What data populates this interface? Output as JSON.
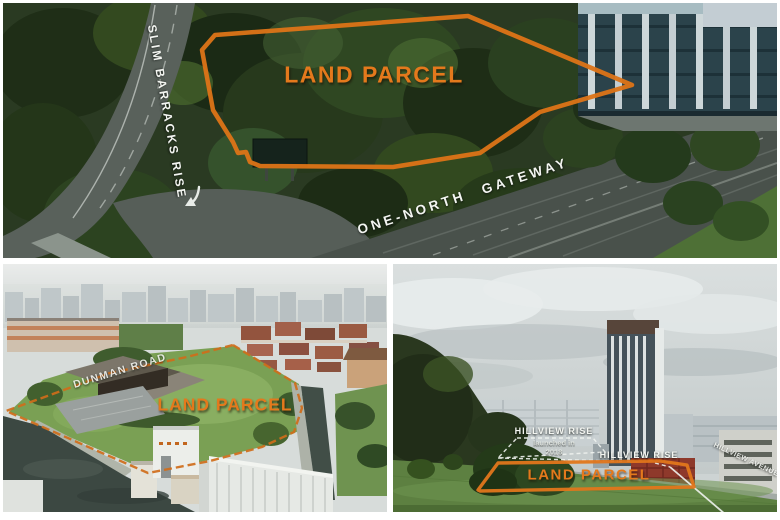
{
  "colors": {
    "annotation_orange": "#e2761b",
    "annotation_white": "#f3f5f1"
  },
  "panel_one_north": {
    "parcel_label": "LAND PARCEL",
    "road_label_vertical": "SLIM BARRACKS RISE",
    "road_label_diagonal": "ONE-NORTH GATEWAY"
  },
  "panel_dunman": {
    "parcel_label": "LAND PARCEL",
    "road_label": "DUNMAN ROAD"
  },
  "panel_hillview": {
    "parcel_label": "LAND PARCEL",
    "adjacent_site_label": "HILLVIEW RISE",
    "adjacent_site_note_line1": "launched in",
    "adjacent_site_note_line2": "2018",
    "street_label": "HILLVIEW RISE",
    "avenue_label": "HILLVIEW AVENUE"
  }
}
